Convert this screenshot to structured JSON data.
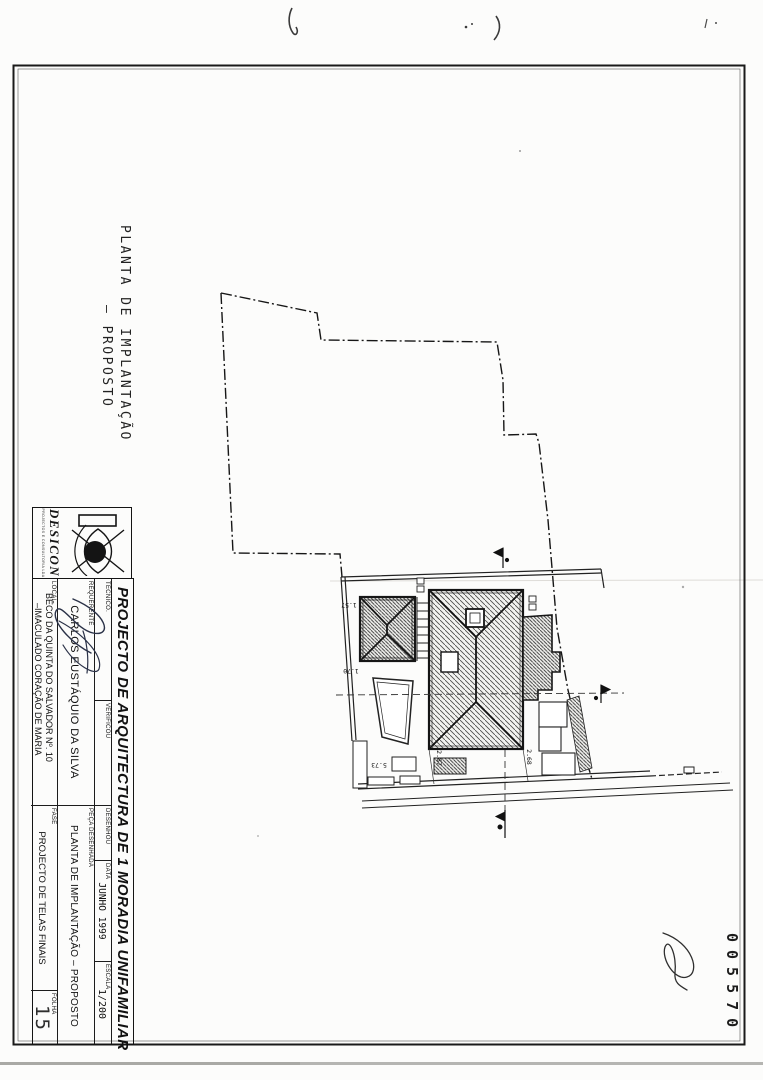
{
  "sheet": {
    "title_line1": "PLANTA DE IMPLANTAÇÃO",
    "title_line2": "—  PROPOSTO"
  },
  "logo": {
    "name": "DESICON",
    "subtext": "PROJECTOS E CONSULTORIA LDA"
  },
  "title_block": {
    "project": "PROJECTO DE ARQUITECTURA DE 1 MORADIA UNIFAMILIAR",
    "tecnico_label": "TÉCNICO.",
    "verificou_label": "VERIFICOU",
    "desenhou_label": "DESENHOU",
    "data_label": "DATA",
    "data_value": "JUNHO 1999",
    "escala_label": "ESCALA",
    "escala_value": "1/200",
    "requerente_label": "REQUERENTE",
    "requerente_value": "CARLOS EUSTÁQUIO DA SILVA",
    "peca_label": "PEÇA DESENHADA",
    "peca_value": "PLANTA DE IMPLANTAÇÃO – PROPOSTO",
    "local_label": "LOCAL",
    "local_line1": "BÊCO DA QUINTA DO SALVADOR Nº. 10",
    "local_line2": "–IMACULADO CORAÇÃO DE MARIA",
    "fase_label": "FASE",
    "fase_value": "PROJECTO DE TELAS FINAIS",
    "folha_label": "FOLHA",
    "folha_value": "15"
  },
  "stamp": {
    "number": "005570"
  },
  "plan": {
    "dims": {
      "d1": "5.73",
      "d2": "2.87",
      "d3": "2.68",
      "d4": "1.70",
      "d5": "1.57"
    }
  }
}
